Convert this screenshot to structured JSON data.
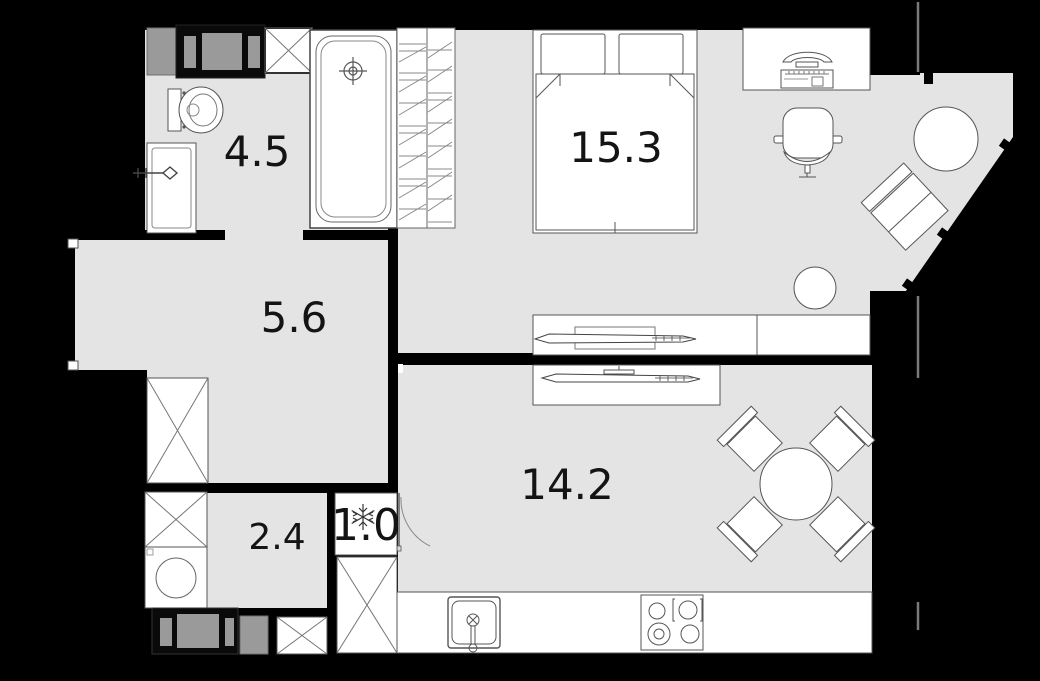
{
  "plan": {
    "title": "apartment-floor-plan",
    "rooms": [
      {
        "name": "bathroom",
        "area": "4.5"
      },
      {
        "name": "bedroom",
        "area": "15.3"
      },
      {
        "name": "hallway",
        "area": "5.6"
      },
      {
        "name": "kitchen-living-room",
        "area": "14.2"
      },
      {
        "name": "laundry-closet",
        "area": "2.4"
      },
      {
        "name": "pantry",
        "area": "1.0"
      }
    ],
    "fixtures": [
      "bathtub",
      "toilet",
      "vanity-sink",
      "ventilation-shaft",
      "wardrobe-hanging-rail",
      "double-bed",
      "desk",
      "computer",
      "office-chair",
      "armchair",
      "round-pouf",
      "stool",
      "tv-console-bedroom",
      "tv-console-kitchen",
      "dining-table",
      "dining-chair",
      "kitchen-counter",
      "kitchen-sink",
      "cooktop-stove",
      "washing-machine",
      "refrigerator",
      "closet-x-box",
      "door-swing"
    ],
    "colors": {
      "background": "#000000",
      "floor": "#e4e4e4",
      "wall": "#000000",
      "fixture_fill": "#ffffff",
      "fixture_stroke": "#555555",
      "shaft_gray": "#9a9a9a",
      "label": "#141414"
    }
  }
}
